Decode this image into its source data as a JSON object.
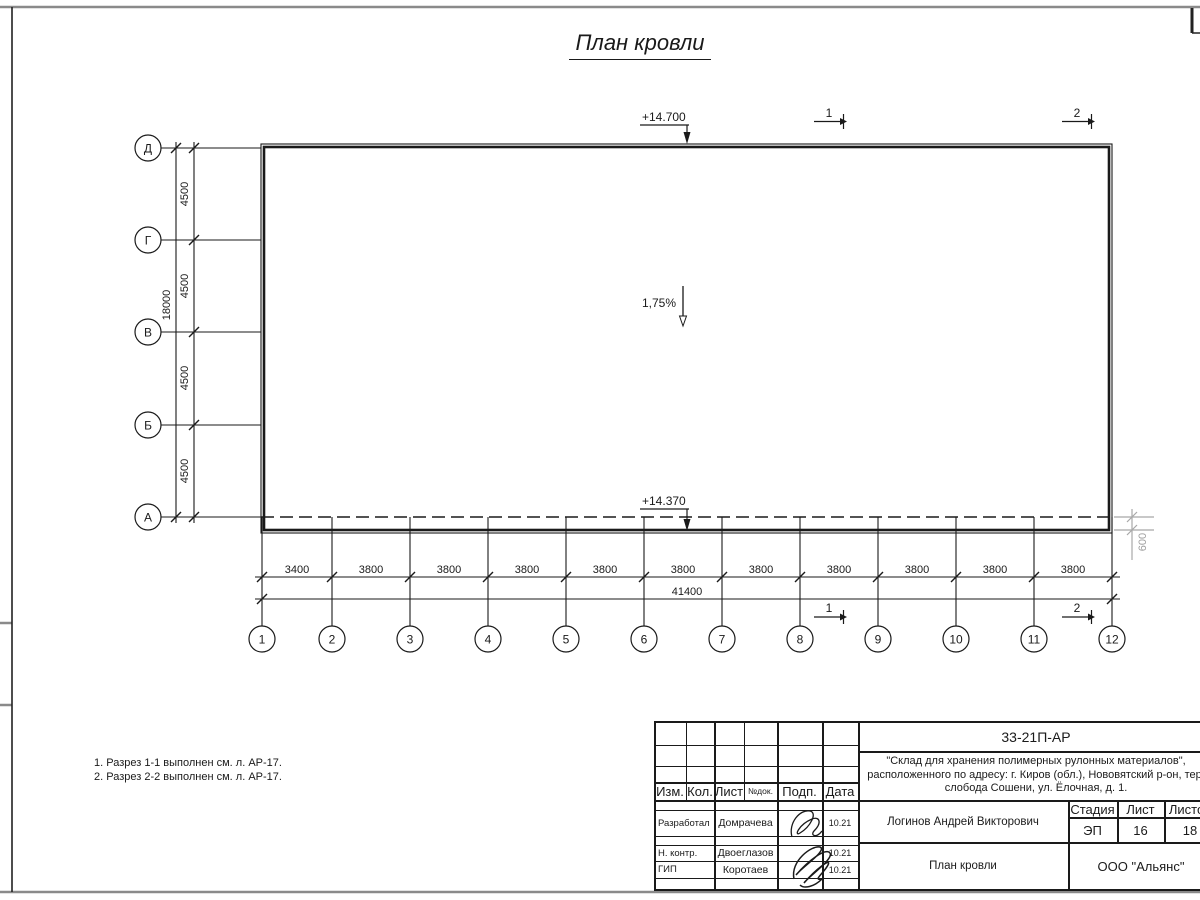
{
  "drawing_title": "План кровли",
  "plan": {
    "elevation_top": "+14.700",
    "elevation_eave": "+14.370",
    "slope": "1,75%",
    "axes_left": [
      "Д",
      "Г",
      "В",
      "Б",
      "А"
    ],
    "axes_bottom": [
      "1",
      "2",
      "3",
      "4",
      "5",
      "6",
      "7",
      "8",
      "9",
      "10",
      "11",
      "12"
    ],
    "dims_left": [
      "4500",
      "4500",
      "4500",
      "4500"
    ],
    "dim_left_total": "18000",
    "dims_bottom": [
      "3400",
      "3800",
      "3800",
      "3800",
      "3800",
      "3800",
      "3800",
      "3800",
      "3800",
      "3800",
      "3800"
    ],
    "dim_bottom_total": "41400",
    "dim_overhang": "600",
    "section_1": "1",
    "section_2": "2"
  },
  "notes": {
    "line1": "1. Разрез 1-1 выполнен см. л. АР-17.",
    "line2": "2. Разрез 2-2 выполнен см. л. АР-17."
  },
  "title_block": {
    "doc_number": "33-21П-АР",
    "project_line1": "\"Склад для хранения полимерных рулонных материалов\",",
    "project_line2": "расположенного по адресу: г. Киров (обл.), Нововятский р-он, тер.",
    "project_line3": "слобода Сошени, ул. Ёлочная, д. 1.",
    "col_izm": "Изм.",
    "col_kol": "Кол.",
    "col_list": "Лист",
    "col_ndok": "№док.",
    "col_podp": "Подп.",
    "col_data": "Дата",
    "rows": [
      {
        "role": "Разработал",
        "name": "Домрачева",
        "date": "10.21"
      },
      {
        "role": "Н. контр.",
        "name": "Двоеглазов",
        "date": "10.21"
      },
      {
        "role": "ГИП",
        "name": "Коротаев",
        "date": "10.21"
      }
    ],
    "chief": "Логинов Андрей Викторович",
    "stage_label": "Стадия",
    "sheet_label": "Лист",
    "sheets_label": "Листов",
    "stage": "ЭП",
    "sheet": "16",
    "sheets": "18",
    "drawing_name": "План кровли",
    "company": "ООО \"Альянс\""
  }
}
